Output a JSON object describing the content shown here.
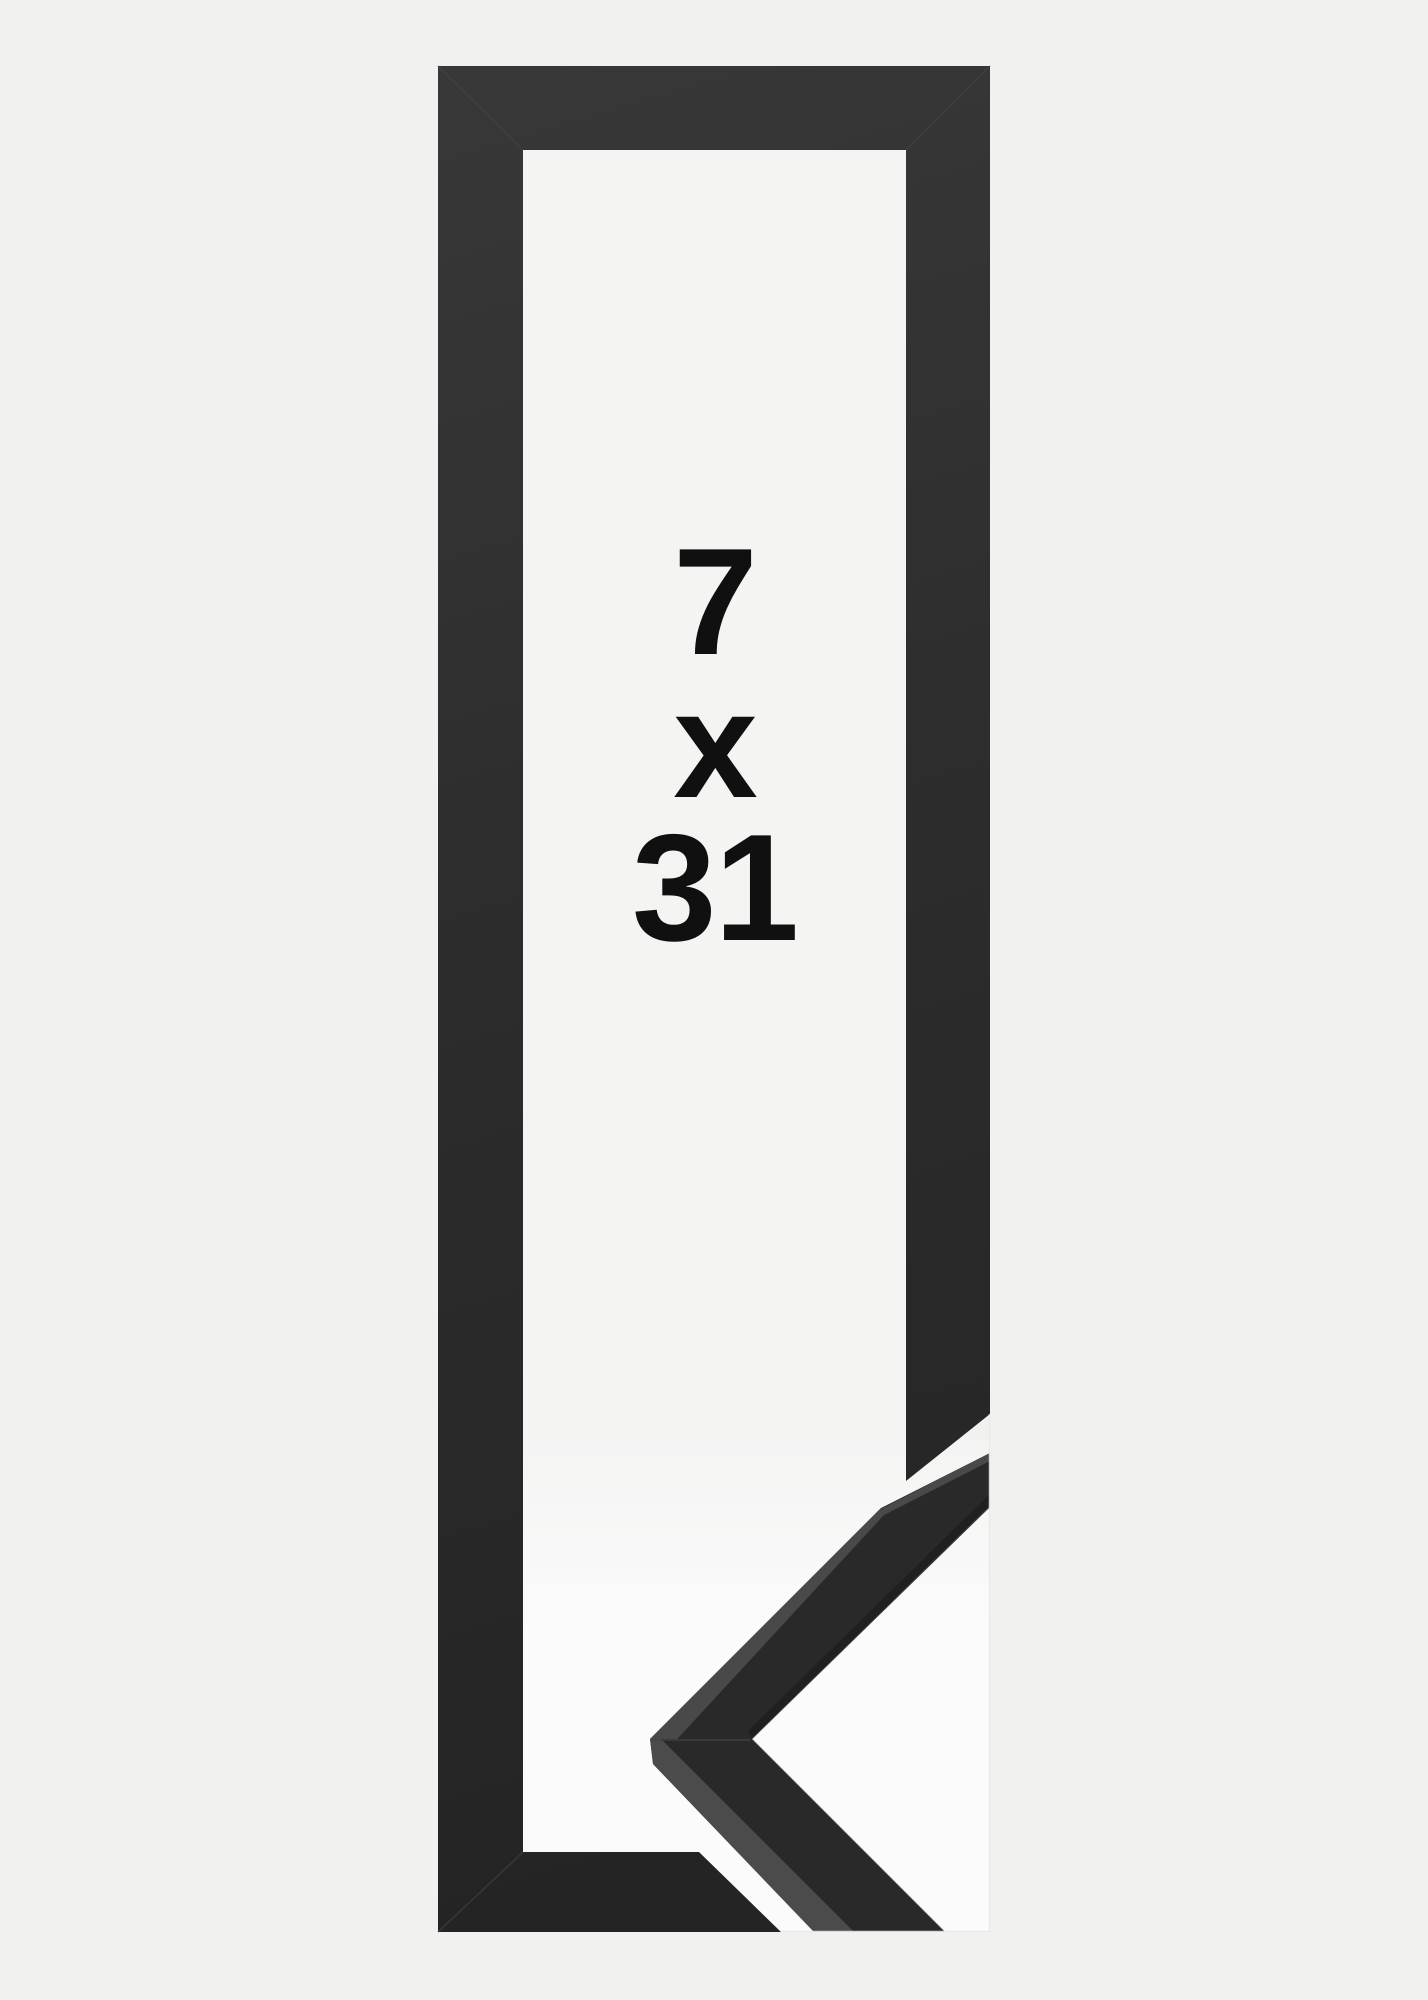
{
  "page": {
    "background_color": "#f1f1f0"
  },
  "product_image": {
    "alt_label": "Black picture frame, corner profile detail, size 7 x 31",
    "size_label": {
      "width_value": "7",
      "separator": "x",
      "height_value": "31"
    },
    "colors": {
      "page_bg": "#f1f1f0",
      "opening_bg": "#f4f4f3",
      "detail_backdrop": "#fbfbfb",
      "frame_left": "#383838",
      "frame_mid": "#2c2c2c",
      "frame_deep": "#232323",
      "arm_face": "#292929",
      "arm_edge_light": "#4f4f4f",
      "seam_light": "#474747",
      "inner_shadow": "#1d1d1d",
      "edge_hairline": "#e9e9e8",
      "text_color": "#101010"
    }
  }
}
